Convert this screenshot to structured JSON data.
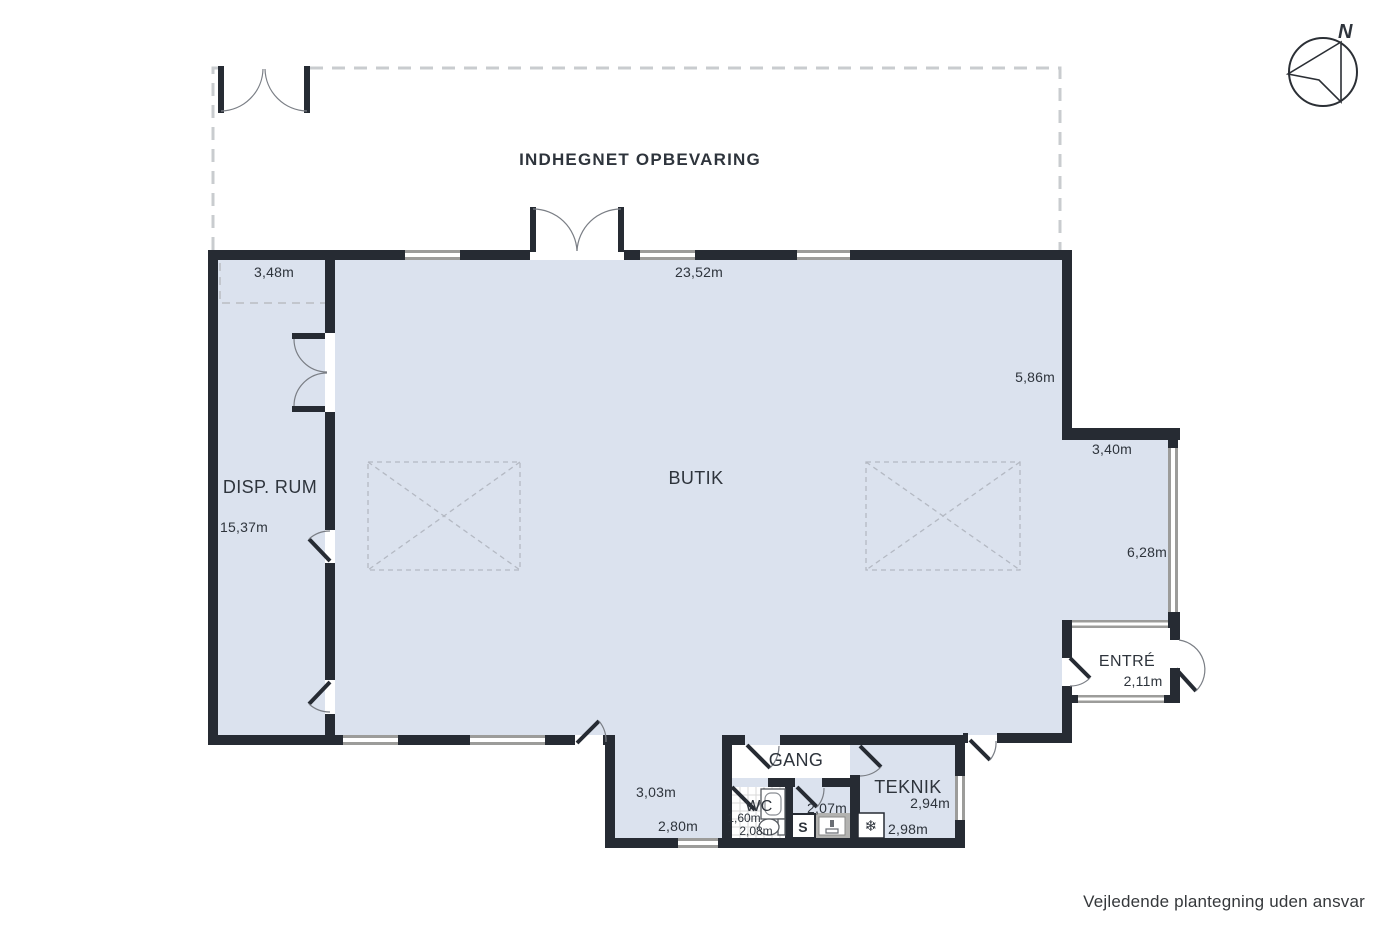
{
  "plan": {
    "outdoor_label": "INDHEGNET OPBEVARING",
    "disclaimer": "Vejledende plantegning uden ansvar",
    "compass_n": "N",
    "rooms": {
      "butik": "BUTIK",
      "disp_rum": "DISP. RUM",
      "entre": "ENTRÉ",
      "gang": "GANG",
      "teknik": "TEKNIK",
      "wc": "WC"
    },
    "dims": {
      "disp_storage_width": "3,48m",
      "butik_top_width": "23,52m",
      "butik_right_height": "5,86m",
      "step_width": "3,40m",
      "right_lower_height": "6,28m",
      "entre_width": "2,11m",
      "disp_height": "15,37m",
      "annex_height": "3,03m",
      "annex_width": "2,80m",
      "wc_width": "1,60m",
      "wc_height": "2,08m",
      "utility_width": "2,07m",
      "teknik_width": "2,94m",
      "teknik_height": "2,98m"
    },
    "fixtures": {
      "cabinet": "S",
      "cooling": "❄"
    },
    "colors": {
      "floor": "#dbe2ee",
      "wall": "#262b33",
      "window": "#9c9c9a",
      "text": "#2e343c"
    }
  }
}
